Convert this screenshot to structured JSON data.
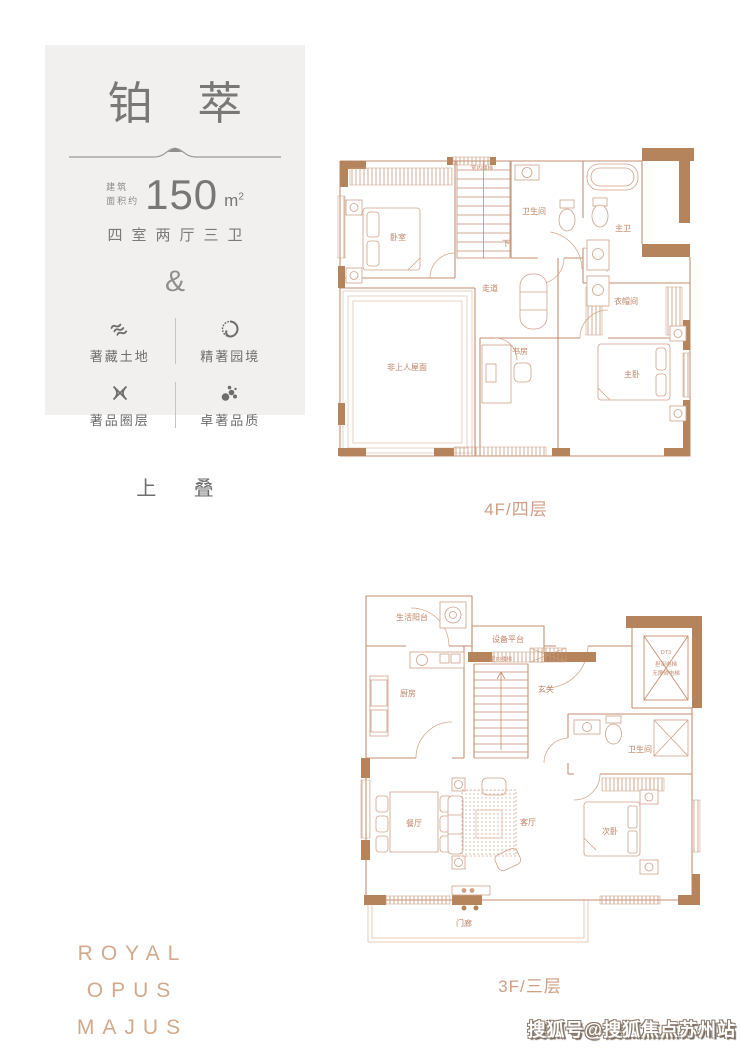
{
  "card": {
    "title": "铂 萃",
    "area_prefix_line1": "建筑",
    "area_prefix_line2": "面积约",
    "area_value": "150",
    "area_unit": "m",
    "area_unit_sup": "2",
    "layout_text": "四室两厅三卫",
    "ampersand": "&",
    "features": [
      {
        "icon": "land-waves-icon",
        "label": "著藏土地"
      },
      {
        "icon": "garden-circle-icon",
        "label": "精著园境"
      },
      {
        "icon": "ribbon-cross-icon",
        "label": "著品圈层"
      },
      {
        "icon": "quality-dots-icon",
        "label": "卓著品质"
      }
    ]
  },
  "stack_label": "上 叠",
  "plan_upper": {
    "caption": "4F/四层",
    "rooms": {
      "bedroom": "卧室",
      "stairs": "室内楼梯",
      "down": "下",
      "bath": "卫生间",
      "master_bath": "主卫",
      "corridor": "走道",
      "closet": "衣帽间",
      "master_bedroom": "主卧",
      "study": "书房",
      "roof": "非上人屋面"
    }
  },
  "plan_lower": {
    "caption": "3F/三层",
    "rooms": {
      "service_balcony": "生活阳台",
      "equipment_platform": "设备平台",
      "stairs": "室内楼梯",
      "kitchen": "厨房",
      "foyer": "玄关",
      "elevator_id": "DT3",
      "elevator_line1": "担架电梯",
      "elevator_line2": "无障碍电梯",
      "bath": "卫生间",
      "dining": "餐厅",
      "living": "客厅",
      "bedroom2": "次卧",
      "porch": "门廊"
    }
  },
  "brand": {
    "line1": "ROYAL OPUS",
    "line2": "MAJUS"
  },
  "watermark": "搜狐号@搜狐焦点苏州站",
  "colors": {
    "card_bg": "#f1f0ee",
    "text_gray": "#787878",
    "plan_line": "#c68f72",
    "plan_wall": "#b5845c",
    "accent_tan": "#cf9e85",
    "brand_tan": "#d2a98c"
  }
}
